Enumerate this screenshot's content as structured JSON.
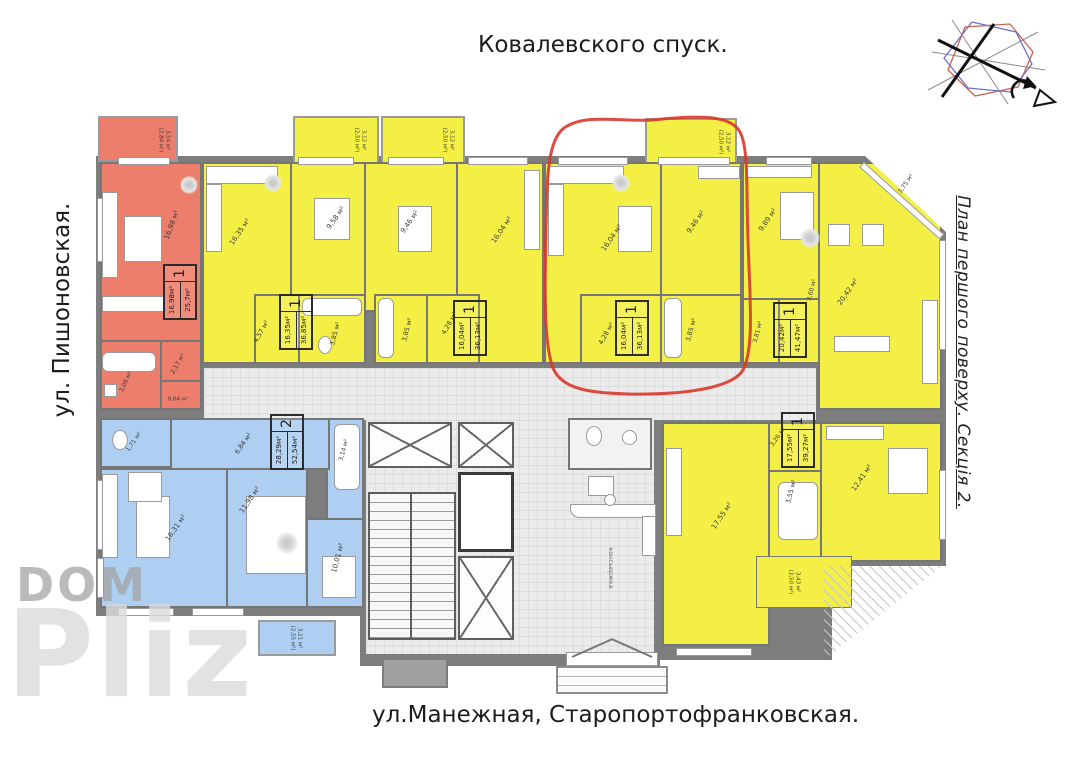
{
  "streets": {
    "top": "Ковалевского спуск.",
    "left": "ул. Пишоновская.",
    "bottom": "ул.Манежная, Старопортофранковская."
  },
  "plan_title": "План першого поверху. Секція 2.",
  "watermark": {
    "word1": "DOM",
    "word2": "Pliz"
  },
  "lobby": {
    "concierge_label": "консьержка"
  },
  "colors": {
    "one_room_apartment": "#f4ef45",
    "studio_apartment": "#ee7e6c",
    "two_room_apartment": "#aecff2",
    "walls": "#7d7d7d",
    "highlight_annotation": "#d8392b"
  },
  "apartments": {
    "a1": {
      "stamp": {
        "rooms": "1",
        "living_area": "16,98м²",
        "total_area": "25,7м²"
      },
      "rooms": {
        "living": "16,98 м²",
        "hall": "2,17 м²",
        "bath": "3,08 м²",
        "closet": "0,64 м²",
        "balcony": "3,54 м²\n(2,84 м²)"
      }
    },
    "a2": {
      "stamp": {
        "rooms": "1",
        "living_area": "16,35м²",
        "total_area": "36,85м²"
      },
      "rooms": {
        "living": "16,35 м²",
        "kitchen": "9,58 м²",
        "hall": "4,57 м²",
        "bath": "3,85 м²",
        "balcony": "3,12 м²\n(2,50 м²)"
      }
    },
    "a3": {
      "stamp": {
        "rooms": "1",
        "living_area": "16,04м²",
        "total_area": "36,13м²"
      },
      "rooms": {
        "kitchen": "9,46 м²",
        "living": "16,04 м²",
        "hall": "4,28 м²",
        "bath": "3,85 м²",
        "balcony": "3,12 м²\n(2,50 м²)"
      }
    },
    "a4": {
      "stamp": {
        "rooms": "1",
        "living_area": "16,04м²",
        "total_area": "36,13м²"
      },
      "rooms": {
        "living": "16,04 м²",
        "kitchen": "9,46 м²",
        "hall": "4,28 м²",
        "bath": "3,85 м²",
        "balcony": "3,12 м²\n(2,50 м²)"
      }
    },
    "a5": {
      "stamp": {
        "rooms": "1",
        "living_area": "20,42м²",
        "total_area": "41,47м²"
      },
      "rooms": {
        "kitchen": "9,89 м²",
        "living": "20,42 м²",
        "hall": "3,60 м²",
        "bath": "3,81 м²",
        "balcony": "3,75 м²"
      }
    },
    "a6": {
      "stamp": {
        "rooms": "2",
        "living_area": "28,29м²",
        "total_area": "52,54м²"
      },
      "rooms": {
        "wc": "1,71 м²",
        "hall": "6,84 м²",
        "bath": "3,14 м²",
        "living": "16,31 м²",
        "bedroom": "11,98 м²",
        "kitchen": "10,01 м²",
        "balcony": "3,21 м²\n(2,55 м²)"
      }
    },
    "a7": {
      "stamp": {
        "rooms": "1",
        "living_area": "17,55м²",
        "total_area": "39,27м²"
      },
      "rooms": {
        "living": "17,55 м²",
        "hall": "3,26 м²",
        "bath": "3,55 м²",
        "kitchen": "12,41 м²",
        "balcony": "3,43 м²\n(2,50 м²)"
      }
    }
  }
}
